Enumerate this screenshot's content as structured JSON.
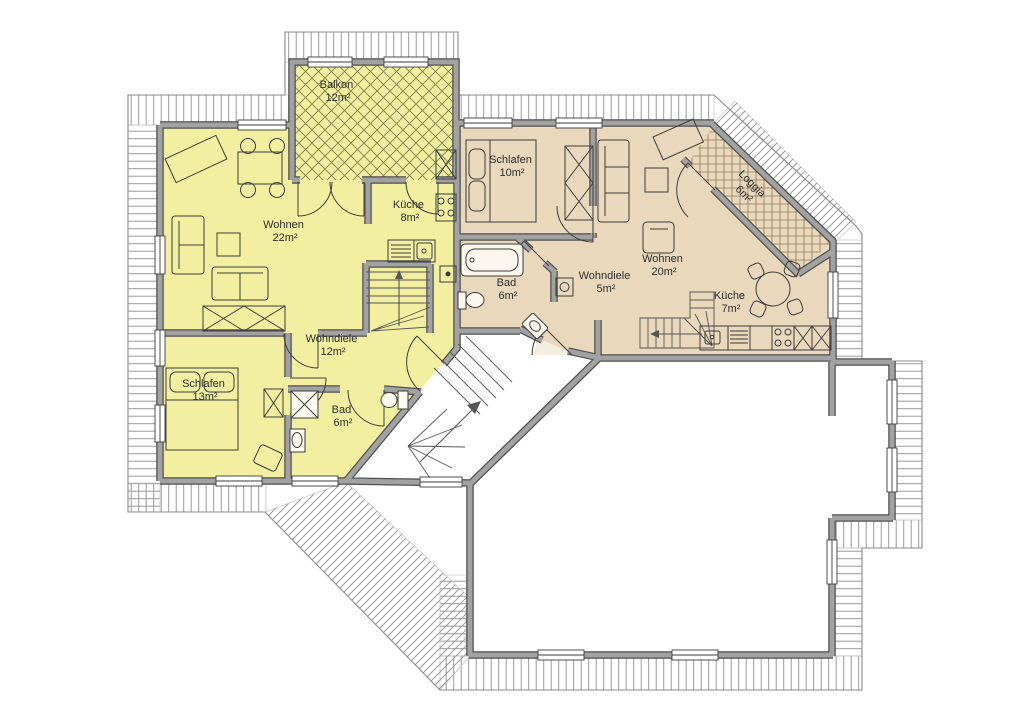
{
  "plan": {
    "type": "floor-plan",
    "floor": "Dachgeschoss apartment floor plan",
    "colors": {
      "apartment_left_fill": "#f2efa0",
      "apartment_right_fill": "#ead8bd",
      "wall_gray": "#a2a2a2",
      "wall_edge": "#4f4f4f",
      "roof_hatch_line": "#9a9a9a",
      "balcony_hatch_line": "#80804c",
      "loggia_grid_line": "#8d7c5c",
      "background": "#ffffff"
    }
  },
  "apartments": {
    "left": {
      "rooms": [
        {
          "id": "wohnen",
          "label": "Wohnen",
          "area": "22m²"
        },
        {
          "id": "kueche",
          "label": "Küche",
          "area": "8m²"
        },
        {
          "id": "balkon",
          "label": "Balkon",
          "area": "12m²"
        },
        {
          "id": "wohndiele",
          "label": "Wohndiele",
          "area": "12m²"
        },
        {
          "id": "schlafen",
          "label": "Schlafen",
          "area": "13m²"
        },
        {
          "id": "bad",
          "label": "Bad",
          "area": "6m²"
        }
      ]
    },
    "right": {
      "rooms": [
        {
          "id": "schlafen",
          "label": "Schlafen",
          "area": "10m²"
        },
        {
          "id": "wohnen",
          "label": "Wohnen",
          "area": "20m²"
        },
        {
          "id": "wohndiele",
          "label": "Wohndiele",
          "area": "5m²"
        },
        {
          "id": "bad",
          "label": "Bad",
          "area": "6m²"
        },
        {
          "id": "kueche",
          "label": "Küche",
          "area": "7m²"
        },
        {
          "id": "loggia",
          "label": "Loggia",
          "area": "6m²"
        }
      ]
    }
  }
}
